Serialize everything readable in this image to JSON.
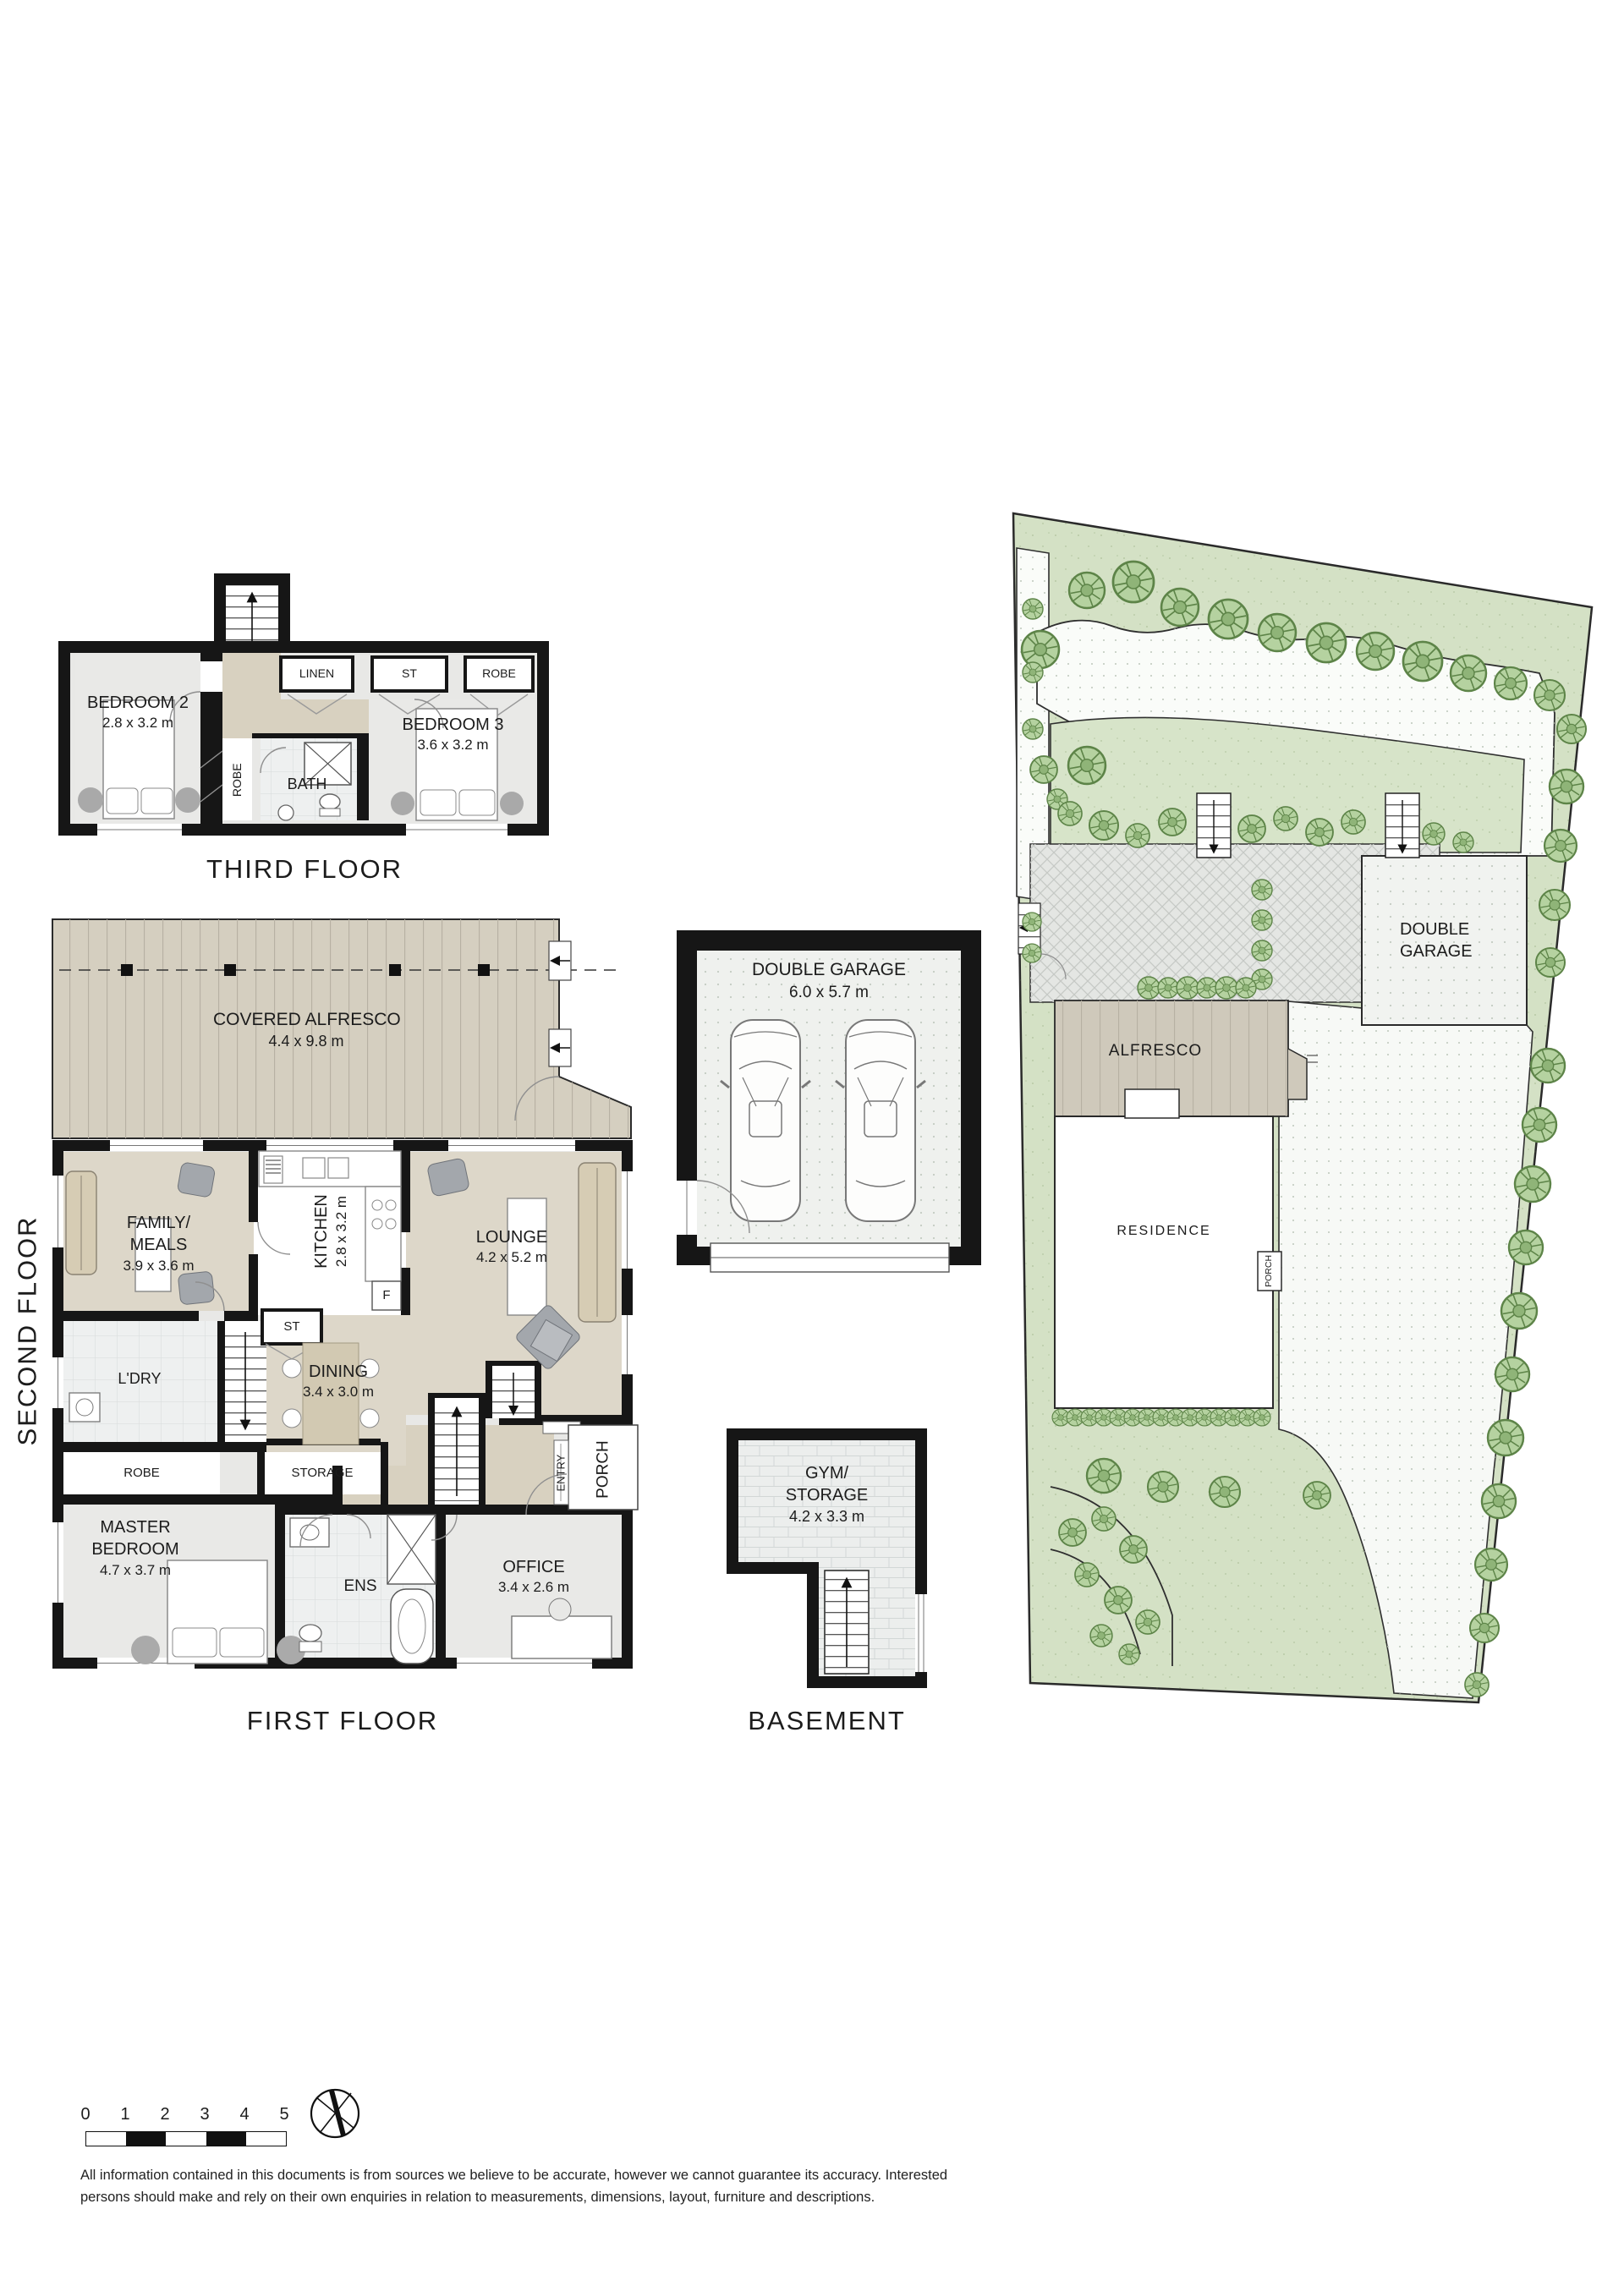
{
  "document": {
    "type": "real-estate floor plan sheet"
  },
  "plans": {
    "third_floor": {
      "title": "THIRD FLOOR",
      "bedroom2_name": "BEDROOM 2",
      "bedroom2_dims": "2.8 x 3.2 m",
      "bedroom3_name": "BEDROOM 3",
      "bedroom3_dims": "3.6 x 3.2 m",
      "linen": "LINEN",
      "st": "ST",
      "robe_top": "ROBE",
      "robe_mid": "ROBE",
      "bath": "BATH"
    },
    "first_floor": {
      "title": "FIRST FLOOR",
      "side_label": "SECOND FLOOR",
      "alfresco_name": "COVERED ALFRESCO",
      "alfresco_dims": "4.4 x 9.8 m",
      "family_line1": "FAMILY/",
      "family_line2": "MEALS",
      "family_dims": "3.9 x 3.6 m",
      "kitchen_name": "KITCHEN",
      "kitchen_dims": "2.8 x 3.2 m",
      "fridge": "F",
      "st": "ST",
      "lounge_name": "LOUNGE",
      "lounge_dims": "4.2 x 5.2 m",
      "dining_name": "DINING",
      "dining_dims": "3.4 x 3.0 m",
      "laundry": "L'DRY",
      "robe": "ROBE",
      "storage": "STORAGE",
      "master_line1": "MASTER",
      "master_line2": "BEDROOM",
      "master_dims": "4.7 x 3.7 m",
      "ensuite": "ENS",
      "office_name": "OFFICE",
      "office_dims": "3.4 x 2.6 m",
      "entry": "ENTRY",
      "porch": "PORCH"
    },
    "garage_plan": {
      "name": "DOUBLE GARAGE",
      "dims": "6.0 x 5.7 m"
    },
    "basement": {
      "title": "BASEMENT",
      "room_line1": "GYM/",
      "room_line2": "STORAGE",
      "room_dims": "4.2 x 3.3 m"
    },
    "site_plan": {
      "residence": "RESIDENCE",
      "alfresco": "ALFRESCO",
      "garage_line1": "DOUBLE",
      "garage_line2": "GARAGE",
      "porch": "PORCH"
    }
  },
  "scale_bar": {
    "labels": [
      "0",
      "1",
      "2",
      "3",
      "4",
      "5"
    ]
  },
  "disclaimer": {
    "line1": "All information contained in this documents is from sources we believe to be accurate, however we cannot guarantee its accuracy. Interested",
    "line2": "persons should make and rely on their own enquiries in relation to measurements, dimensions, layout, furniture and descriptions."
  },
  "colors": {
    "wall": "#161616",
    "floor_gray": "#e8e8e6",
    "floor_beige": "#ddd7c9",
    "hall_tan": "#d8d1c0",
    "deck": "#d5cfc0",
    "tile": "#eef0f0",
    "lawn": "#d4e1c5",
    "tree_fill": "#b5d2a0",
    "tree_stroke": "#5d8448",
    "paving": "#fafcf9",
    "text": "#1b1b1b"
  }
}
